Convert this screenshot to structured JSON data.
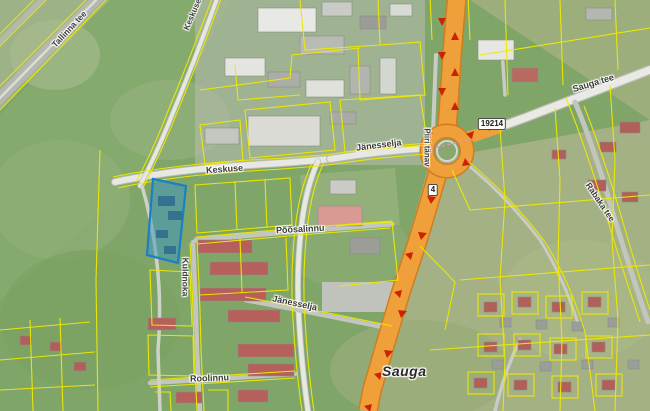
{
  "map": {
    "place_label": "Sauga",
    "street_labels": [
      {
        "id": 0,
        "text": "Tallinna tee"
      },
      {
        "id": 1,
        "text": "Keskuse"
      },
      {
        "id": 2,
        "text": "Keskuse"
      },
      {
        "id": 3,
        "text": "Jänesselja"
      },
      {
        "id": 4,
        "text": "Piiri tänav"
      },
      {
        "id": 5,
        "text": "Sauga tee"
      },
      {
        "id": 6,
        "text": "Rabaka tee"
      },
      {
        "id": 7,
        "text": "Põõsalinnu"
      },
      {
        "id": 8,
        "text": "Kuldnoka"
      },
      {
        "id": 9,
        "text": "Jänesselja"
      },
      {
        "id": 10,
        "text": "Roolinnu"
      }
    ],
    "road_shields": [
      {
        "number": "19214"
      },
      {
        "number": "4"
      }
    ],
    "legend": {
      "highlighted_parcel_color": "#2f8fd0",
      "cadastral_line_color": "#f0e900",
      "main_road_color": "#f0a03a",
      "direction_arrow_color": "#cc2200"
    }
  }
}
